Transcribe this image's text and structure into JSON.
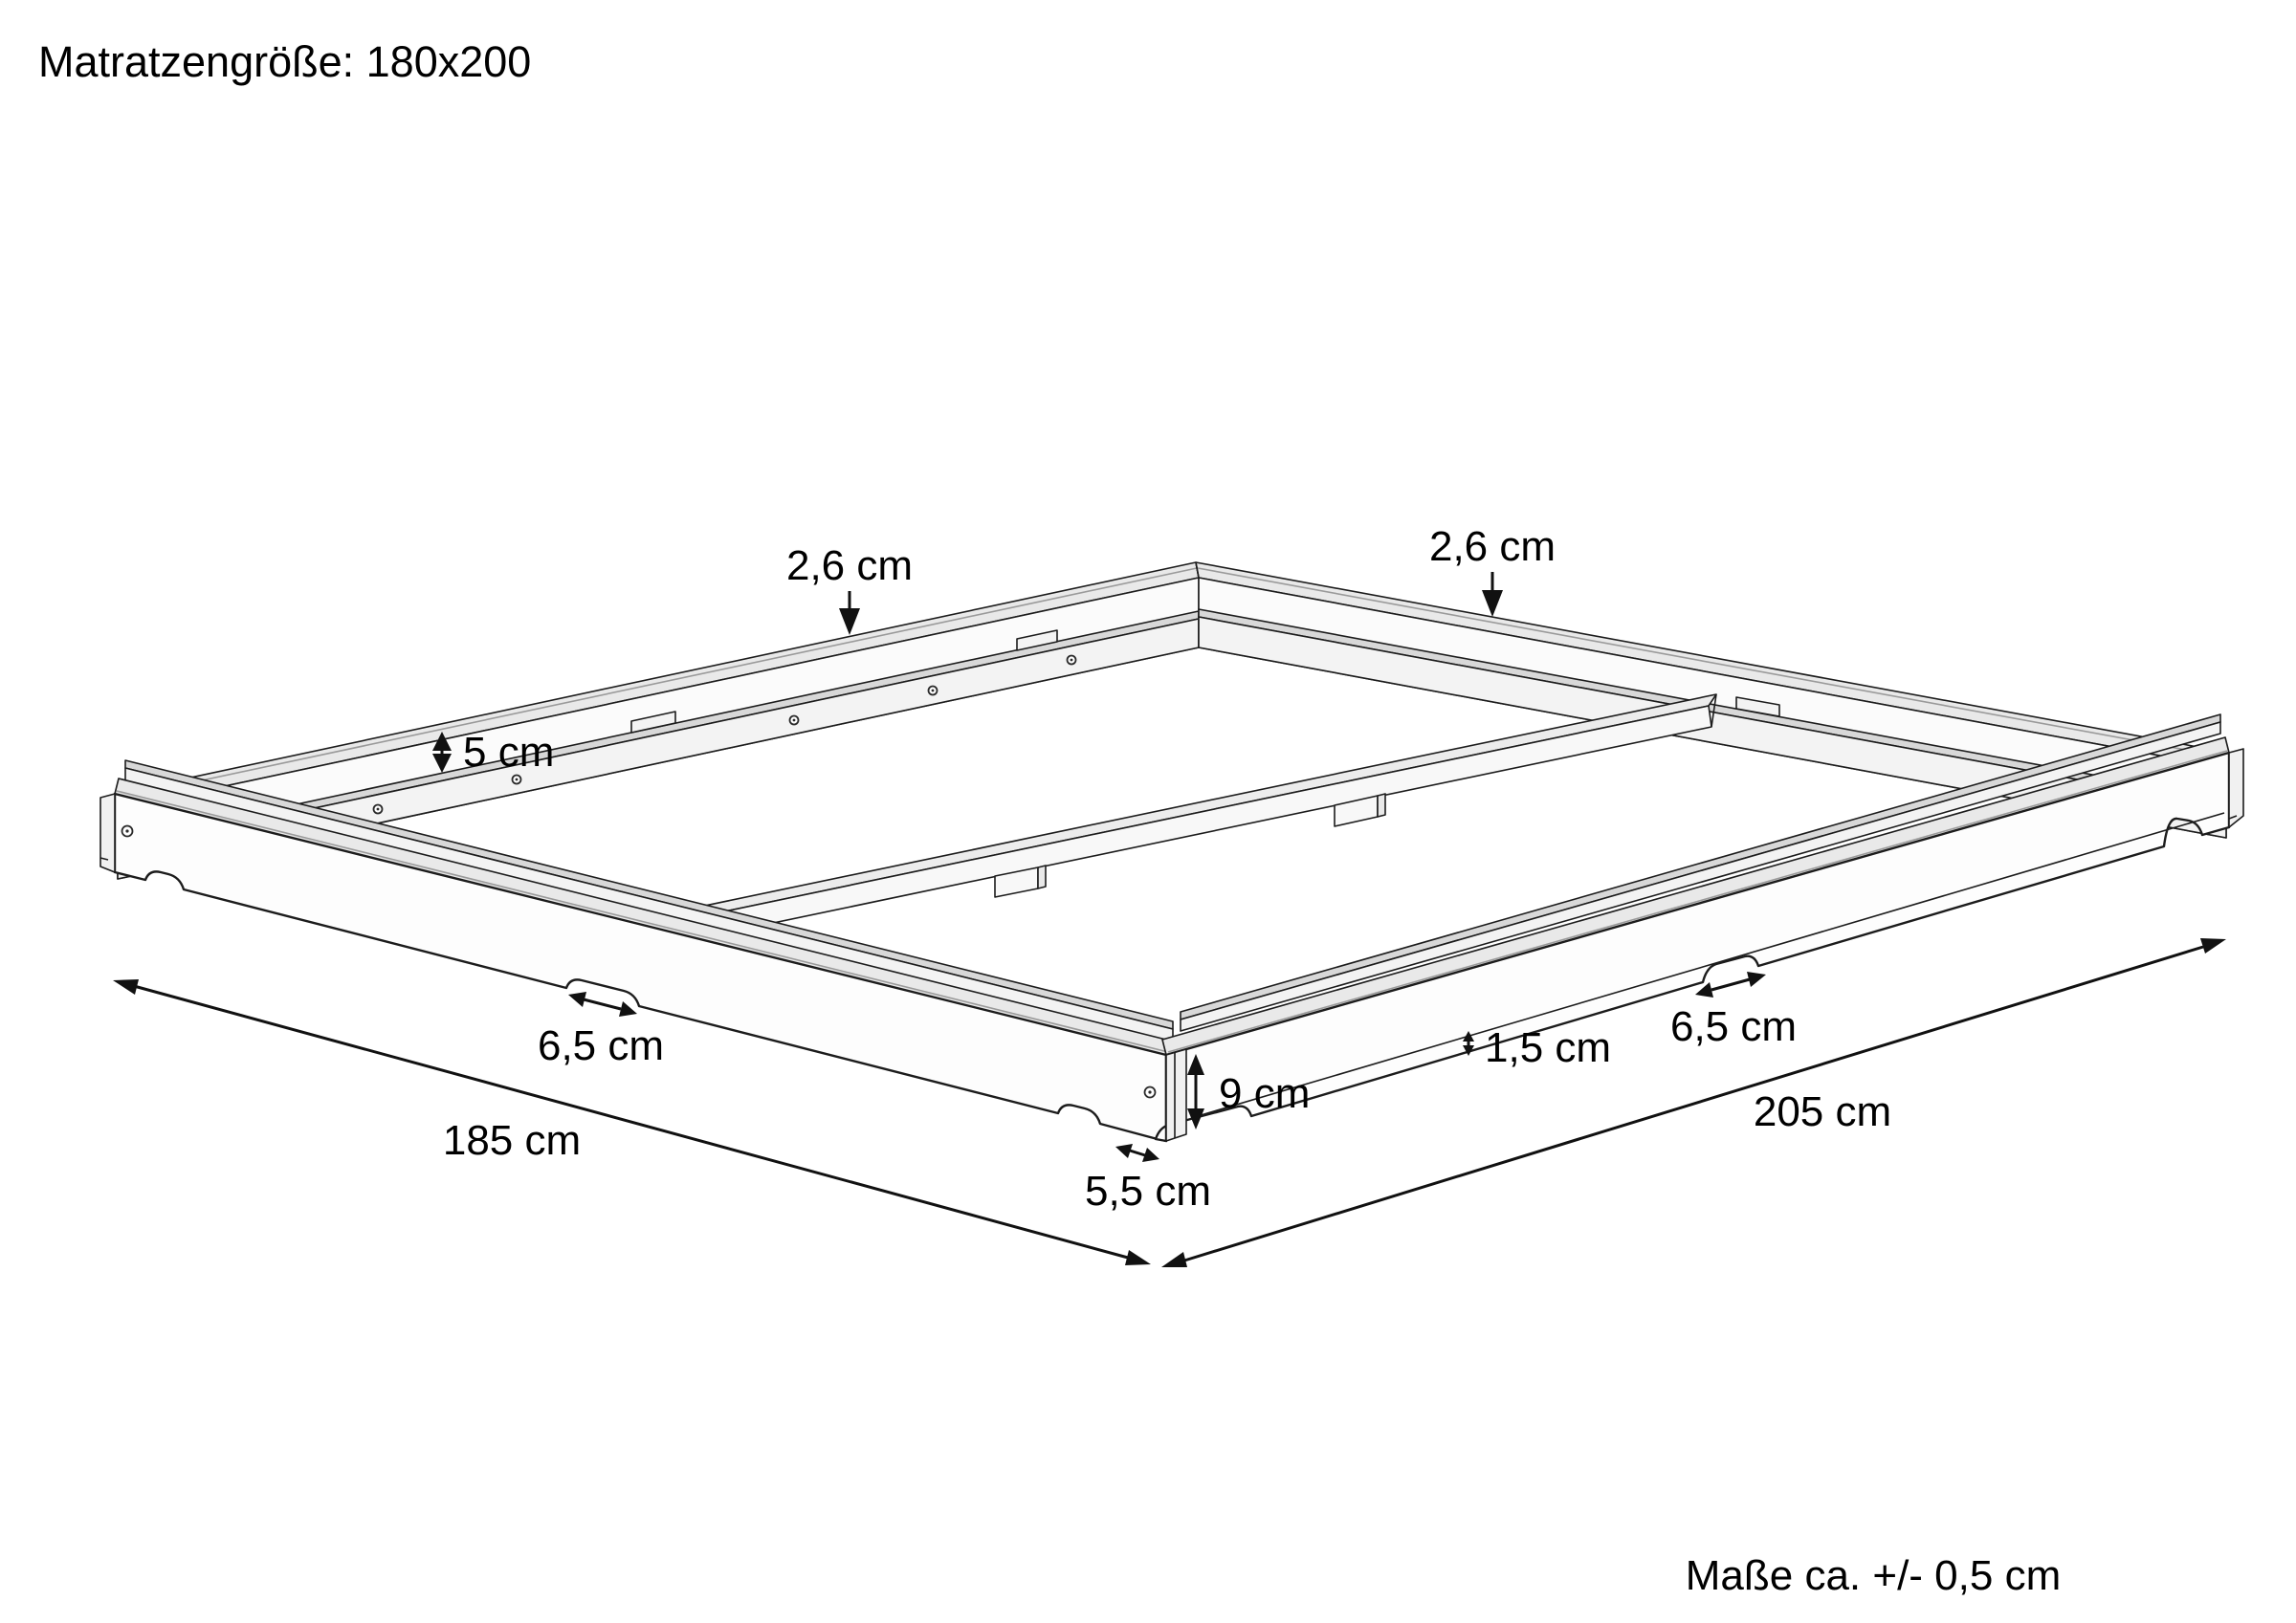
{
  "header": {
    "title": "Matratzengröße: 180x200"
  },
  "footer": {
    "tolerance_note": "Maße ca. +/- 0,5 cm"
  },
  "colors": {
    "background": "#ffffff",
    "line": "#1c1c1c",
    "dimension": "#111111",
    "face_white": "#fbfbfb",
    "face_shaded": "#e9e9e9",
    "face_ledge": "#d8d8d8"
  },
  "diagram": {
    "labels": {
      "thickness_back_left": "2,6 cm",
      "thickness_back_right": "2,6 cm",
      "ledge_depth": "5 cm",
      "cutout_front_left": "6,5 cm",
      "cutout_front_right": "6,5 cm",
      "ledge_reveal": "1,5 cm",
      "side_height": "9 cm",
      "frame_width": "185 cm",
      "frame_length": "205 cm",
      "corner_foot": "5,5 cm"
    }
  }
}
